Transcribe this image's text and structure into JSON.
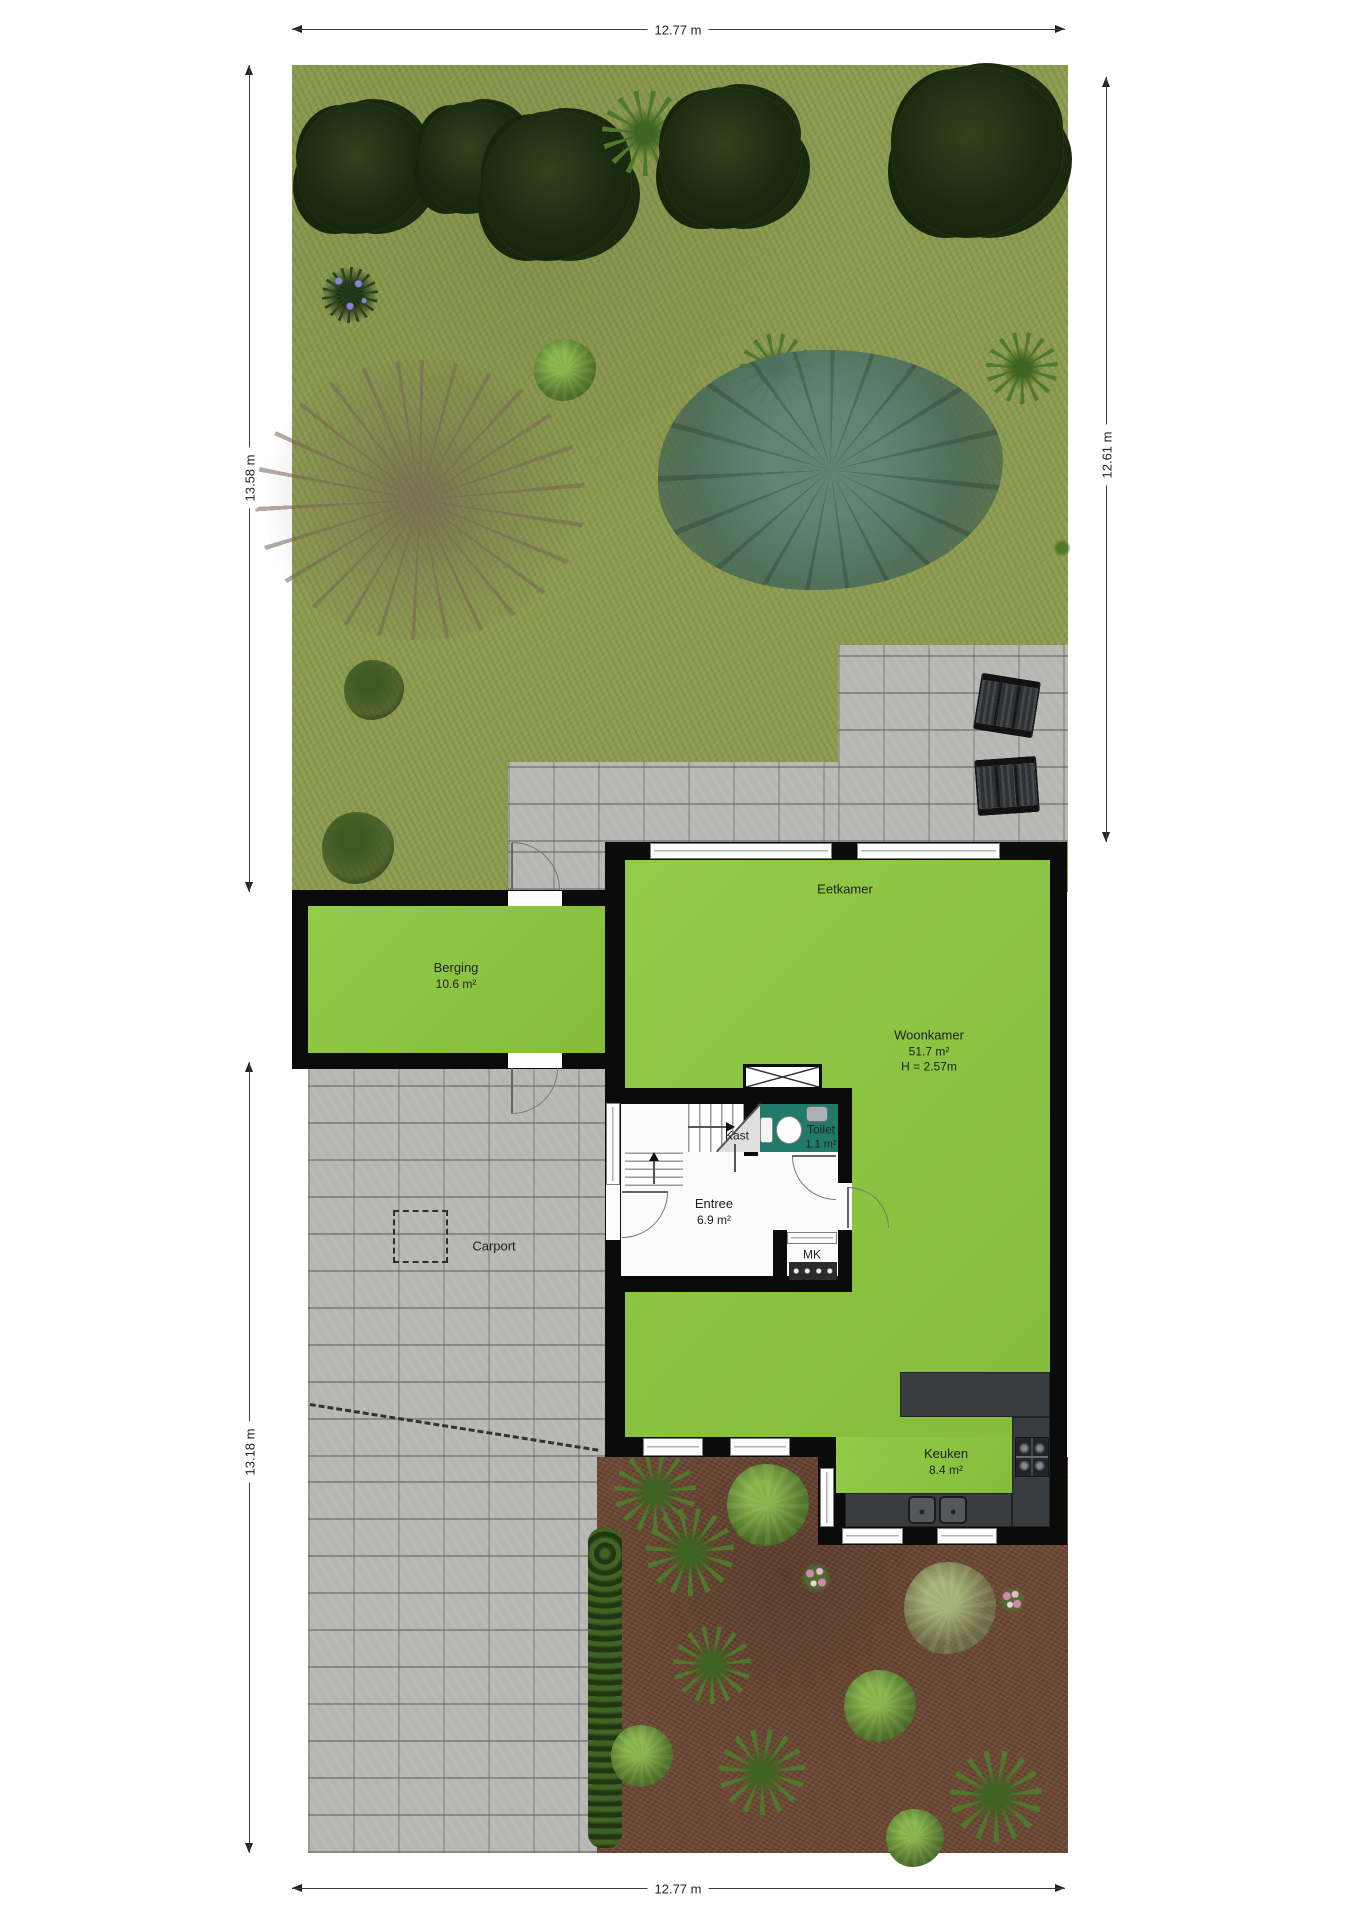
{
  "dims": {
    "top": "12.77 m",
    "bottom": "12.77 m",
    "left_upper": "13.58 m",
    "left_lower": "13.18 m",
    "right": "12.61 m"
  },
  "rooms": {
    "berging": {
      "name": "Berging",
      "area": "10.6 m²"
    },
    "eetkamer": {
      "name": "Eetkamer"
    },
    "woonkamer": {
      "name": "Woonkamer",
      "area": "51.7 m²",
      "ceiling": "H = 2.57m"
    },
    "toilet": {
      "name": "Toilet",
      "area": "1.1 m²"
    },
    "kast": {
      "name": "Kast"
    },
    "entree": {
      "name": "Entree",
      "area": "6.9 m²"
    },
    "mk": {
      "name": "MK"
    },
    "carport": {
      "name": "Carport"
    },
    "keuken": {
      "name": "Keuken",
      "area": "8.4 m²"
    }
  },
  "colors": {
    "grass": "#8d9b52",
    "pavers": "#b6b6b3",
    "dirt": "#6d4a37",
    "floor_green": "#8cc73e",
    "toilet_teal": "#1f7b68",
    "wall": "#0b0b0b",
    "counter": "#3a3d40",
    "hedge": "#2c471a"
  },
  "site": {
    "plants": [
      {
        "t": "tree-dark",
        "x": 363,
        "y": 168,
        "s": 132
      },
      {
        "t": "tree-dark",
        "x": 474,
        "y": 158,
        "s": 112
      },
      {
        "t": "tree-dark",
        "x": 557,
        "y": 186,
        "s": 150
      },
      {
        "t": "palm",
        "x": 645,
        "y": 133,
        "s": 86
      },
      {
        "t": "tree-dark",
        "x": 731,
        "y": 158,
        "s": 142
      },
      {
        "t": "tree-dark",
        "x": 978,
        "y": 152,
        "s": 172
      },
      {
        "t": "spiky",
        "x": 350,
        "y": 295,
        "s": 56
      },
      {
        "t": "bush",
        "x": 565,
        "y": 370,
        "s": 62
      },
      {
        "t": "palm",
        "x": 776,
        "y": 369,
        "s": 72
      },
      {
        "t": "palm",
        "x": 1022,
        "y": 368,
        "s": 72
      },
      {
        "t": "teal-tree",
        "x": 830,
        "y": 470,
        "w": 345,
        "h": 240
      },
      {
        "t": "bare-tree",
        "x": 420,
        "y": 500,
        "w": 330,
        "h": 280
      },
      {
        "t": "bush-dark",
        "x": 374,
        "y": 690,
        "s": 60
      },
      {
        "t": "bush-dark",
        "x": 358,
        "y": 848,
        "s": 72
      },
      {
        "t": "sprig",
        "x": 1062,
        "y": 548,
        "s": 18
      },
      {
        "t": "palm",
        "x": 655,
        "y": 1492,
        "s": 82
      },
      {
        "t": "palm",
        "x": 690,
        "y": 1552,
        "s": 88
      },
      {
        "t": "bush",
        "x": 768,
        "y": 1505,
        "s": 82
      },
      {
        "t": "flowers",
        "x": 816,
        "y": 1578,
        "s": 30
      },
      {
        "t": "bush-pale",
        "x": 950,
        "y": 1608,
        "s": 92
      },
      {
        "t": "palm",
        "x": 712,
        "y": 1665,
        "s": 78
      },
      {
        "t": "bush",
        "x": 642,
        "y": 1756,
        "s": 62
      },
      {
        "t": "palm",
        "x": 762,
        "y": 1772,
        "s": 86
      },
      {
        "t": "bush",
        "x": 880,
        "y": 1706,
        "s": 72
      },
      {
        "t": "palm",
        "x": 996,
        "y": 1796,
        "s": 92
      },
      {
        "t": "flowers",
        "x": 1012,
        "y": 1600,
        "s": 26
      },
      {
        "t": "bush",
        "x": 915,
        "y": 1838,
        "s": 58
      }
    ],
    "furniture": [
      {
        "t": "chair",
        "x": 1007,
        "y": 705,
        "w": 60,
        "h": 57,
        "r": 9
      },
      {
        "t": "chair",
        "x": 1007,
        "y": 786,
        "w": 62,
        "h": 56,
        "r": -4
      }
    ]
  }
}
